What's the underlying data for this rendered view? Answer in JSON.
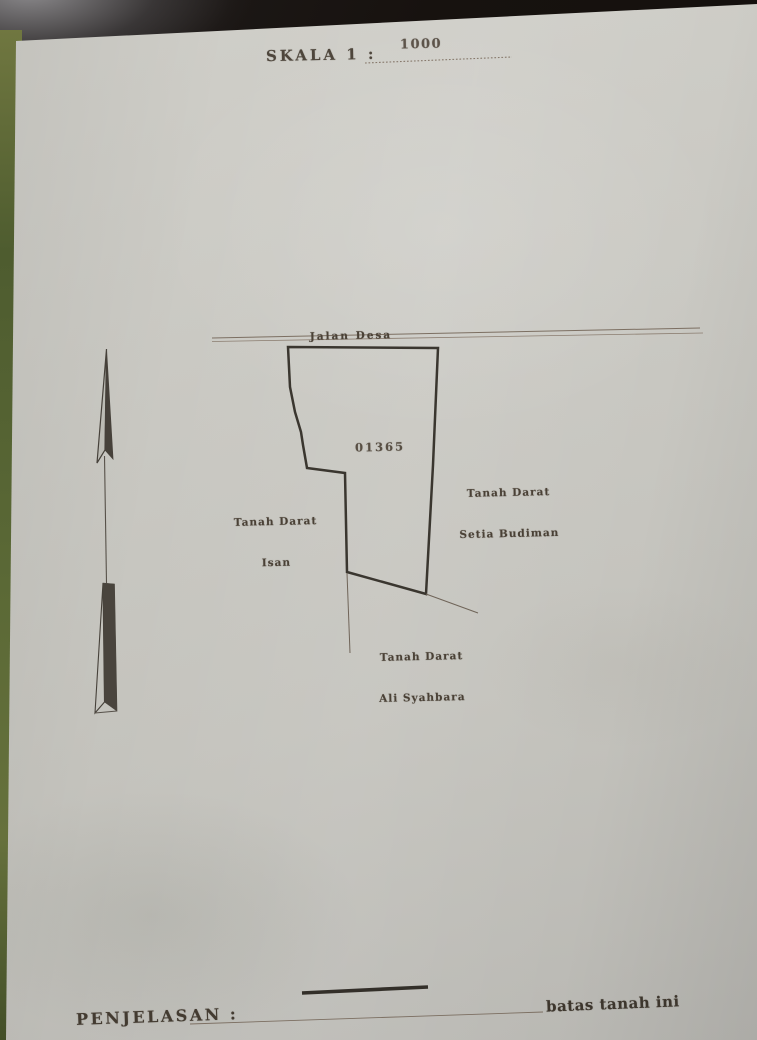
{
  "scale": {
    "label": "SKALA 1 :",
    "value": "1000"
  },
  "sketch": {
    "road_label": "Jalan Desa",
    "parcel_number": "01365",
    "neighbor_right_line1": "Tanah Darat",
    "neighbor_right_line2": "Setia Budiman",
    "neighbor_left_line1": "Tanah Darat",
    "neighbor_left_line2": "Isan",
    "neighbor_bottom_line1": "Tanah Darat",
    "neighbor_bottom_line2": "Ali Syahbara"
  },
  "legend": {
    "heading": "PENJELASAN :",
    "boundary_item": "batas tanah ini"
  },
  "colors": {
    "paper": "#c9c8c2",
    "ink": "#4a4136",
    "boundary_line": "#3a362f",
    "background": "#17120f",
    "binding_green": "#55642f"
  }
}
